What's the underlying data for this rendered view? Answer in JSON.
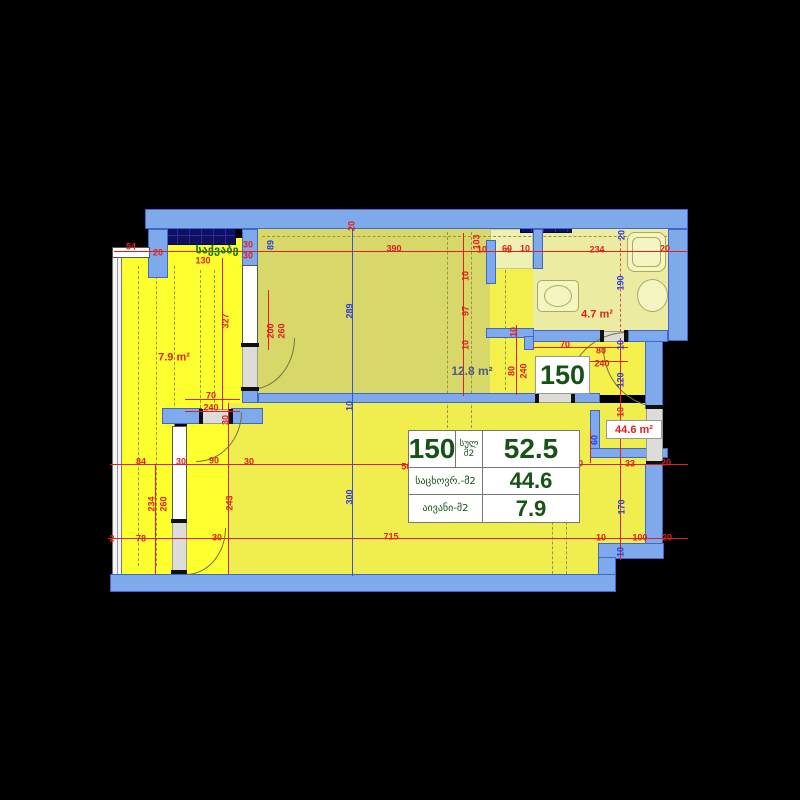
{
  "plan": {
    "unit_number": "150",
    "rooms": {
      "boiler_label": "საქვაბე",
      "balcony_area": "7.9 m²",
      "bedroom_area": "12.8 m²",
      "bathroom_area": "4.7 m²",
      "living_area": "44.6 m²"
    },
    "summary_table": {
      "unit": "150",
      "total_label": "სულ",
      "sq_label": "მ2",
      "total_value": "52.5",
      "residential_label": "საცხოვრ.-მ2",
      "residential_value": "44.6",
      "balcony_label": "აივანი-მ2",
      "balcony_value": "7.9"
    },
    "colors": {
      "wall": "#7ea9ea",
      "balcony_fill": "#fdff2f",
      "living_fill": "#f0ed4f",
      "hall_fill": "#f4f04c",
      "bedroom_fill": "#d7d76a",
      "bathroom_fill": "#ebeca2",
      "shaft": "#10115e",
      "dim_red": "#e02020",
      "dim_blue": "#2a3ed8",
      "label_green": "#157a15",
      "table_green": "#175216"
    },
    "dims": [
      [
        "54",
        131,
        247,
        0,
        "r"
      ],
      [
        "20",
        158,
        253,
        0,
        "r"
      ],
      [
        "130",
        203,
        261,
        0,
        "r"
      ],
      [
        "30",
        248,
        245,
        0,
        "r"
      ],
      [
        "30",
        248,
        256,
        0,
        "r"
      ],
      [
        "20",
        352,
        226,
        1,
        "r"
      ],
      [
        "390",
        394,
        249,
        0,
        "r"
      ],
      [
        "103",
        477,
        242,
        1,
        "r"
      ],
      [
        "10",
        482,
        250,
        0,
        "r"
      ],
      [
        "60",
        507,
        249,
        0,
        "r"
      ],
      [
        "10",
        525,
        249,
        0,
        "r"
      ],
      [
        "234",
        597,
        250,
        0,
        "r"
      ],
      [
        "20",
        665,
        249,
        0,
        "r"
      ],
      [
        "20",
        622,
        235,
        1,
        "b"
      ],
      [
        "89",
        271,
        245,
        1,
        "b"
      ],
      [
        "289",
        350,
        311,
        1,
        "b"
      ],
      [
        "190",
        621,
        283,
        1,
        "b"
      ],
      [
        "327",
        226,
        321,
        1,
        "r"
      ],
      [
        "200",
        271,
        331,
        1,
        "r"
      ],
      [
        "260",
        282,
        331,
        1,
        "r"
      ],
      [
        "97",
        466,
        311,
        1,
        "r"
      ],
      [
        "10",
        466,
        276,
        1,
        "r"
      ],
      [
        "10",
        466,
        345,
        1,
        "r"
      ],
      [
        "10",
        514,
        332,
        1,
        "r"
      ],
      [
        "70",
        565,
        345,
        0,
        "r"
      ],
      [
        "80",
        601,
        351,
        0,
        "r"
      ],
      [
        "240",
        602,
        364,
        0,
        "r"
      ],
      [
        "70",
        211,
        396,
        0,
        "r"
      ],
      [
        "240",
        211,
        408,
        0,
        "r"
      ],
      [
        "30",
        226,
        420,
        1,
        "r"
      ],
      [
        "80",
        512,
        371,
        1,
        "r"
      ],
      [
        "240",
        524,
        371,
        1,
        "r"
      ],
      [
        "10",
        621,
        345,
        1,
        "b"
      ],
      [
        "120",
        621,
        380,
        1,
        "b"
      ],
      [
        "10",
        621,
        412,
        1,
        "r"
      ],
      [
        "60",
        595,
        440,
        1,
        "b"
      ],
      [
        "10",
        350,
        406,
        1,
        "b"
      ],
      [
        "84",
        141,
        462,
        0,
        "r"
      ],
      [
        "30",
        181,
        462,
        0,
        "r"
      ],
      [
        "90",
        214,
        461,
        0,
        "r"
      ],
      [
        "30",
        249,
        462,
        0,
        "r"
      ],
      [
        "56.1",
        410,
        467,
        0,
        "r"
      ],
      [
        "10",
        578,
        464,
        0,
        "r"
      ],
      [
        "33",
        630,
        464,
        0,
        "r"
      ],
      [
        "20",
        666,
        463,
        0,
        "r"
      ],
      [
        "234",
        152,
        504,
        1,
        "r"
      ],
      [
        "260",
        164,
        504,
        1,
        "r"
      ],
      [
        "243",
        230,
        503,
        1,
        "r"
      ],
      [
        "300",
        350,
        497,
        1,
        "b"
      ],
      [
        "170",
        622,
        507,
        1,
        "b"
      ],
      [
        "2",
        112,
        539,
        0,
        "r"
      ],
      [
        "78",
        141,
        539,
        0,
        "r"
      ],
      [
        "30",
        217,
        538,
        0,
        "r"
      ],
      [
        "715",
        391,
        537,
        0,
        "r"
      ],
      [
        "10",
        601,
        538,
        0,
        "r"
      ],
      [
        "100",
        640,
        538,
        0,
        "r"
      ],
      [
        "20",
        667,
        538,
        0,
        "r"
      ],
      [
        "10",
        621,
        552,
        1,
        "b"
      ]
    ]
  }
}
